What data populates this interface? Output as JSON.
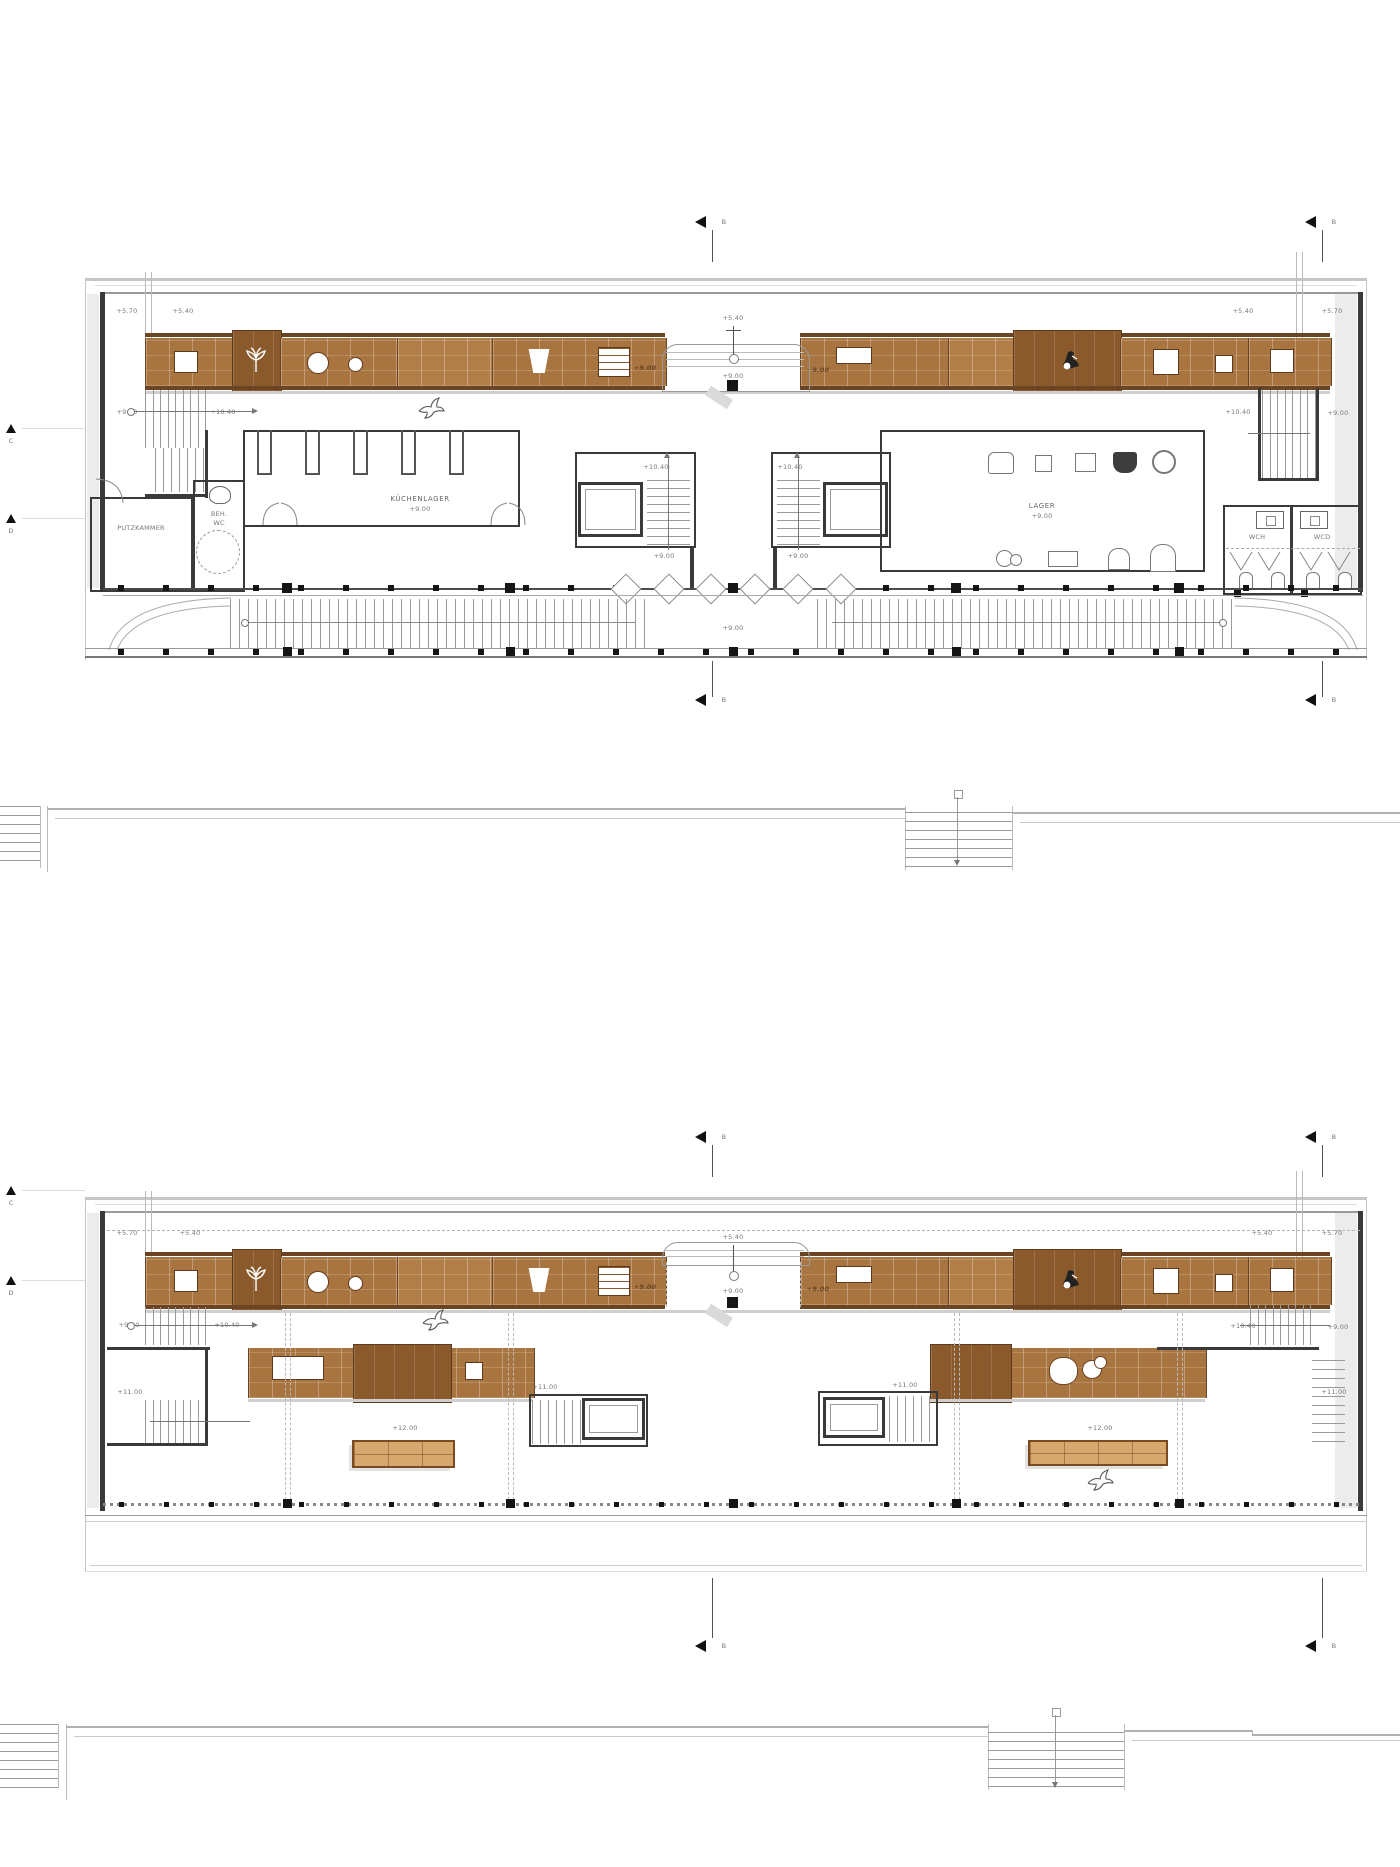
{
  "meta": {
    "drawing_type": "architectural floor plans",
    "sheets_visible": 2
  },
  "colors": {
    "wood": "#a87440",
    "wood_dark": "#8a5a2c",
    "wood_edge": "#6b4423",
    "wall": "#3a3a3a",
    "frame_gray": "#c6c6c6",
    "ink": "#777777",
    "bench_wood": "#d7a86e",
    "column_black": "#151515"
  },
  "section_marker": {
    "label": "B"
  },
  "row_markers": {
    "c": "C",
    "d": "D"
  },
  "plan1": {
    "elevations": {
      "top_left_outer": "+5.70",
      "top_left_inner": "+5.40",
      "top_center": "+5.40",
      "top_right_inner": "+5.40",
      "top_right_outer": "+5.70",
      "corridor_left": "+9.00",
      "stair_left_up": "+10.40",
      "band_left": "+9.00",
      "band_right": "+9.00",
      "center_floor": "+9.00",
      "core_left_up": "+10.40",
      "core_left_floor": "+9.00",
      "core_right_up": "+10.40",
      "core_right_floor": "+9.00",
      "stair_right_up": "+10.40",
      "corridor_right": "+9.00",
      "terrace": "+9.00"
    },
    "rooms": {
      "putzkammer": "PUTZKAMMER",
      "beh_wc_1": "BEH.",
      "beh_wc_2": "WC",
      "kuechenlager": "KÜCHENLAGER",
      "kuechenlager_level": "+9.00",
      "lager": "LAGER",
      "lager_level": "+9.00",
      "wc_h": "WCH",
      "wc_d": "WCD"
    }
  },
  "plan2": {
    "elevations": {
      "top_left_outer": "+5.70",
      "top_left_inner": "+5.40",
      "top_center": "+5.40",
      "top_right_inner": "+5.40",
      "top_right_outer": "+5.70",
      "corridor_left": "+9.00",
      "stair_left_up": "+10.40",
      "band_left": "+9.00",
      "band_right": "+9.00",
      "center_floor": "+9.00",
      "gallery_left": "+11.00",
      "core_left": "+11.00",
      "core_right": "+11.00",
      "gallery_right": "+11.00",
      "bench_left": "+12.00",
      "bench_right": "+12.00",
      "stair_right_up": "+10.40",
      "corridor_right": "+9.00"
    }
  }
}
